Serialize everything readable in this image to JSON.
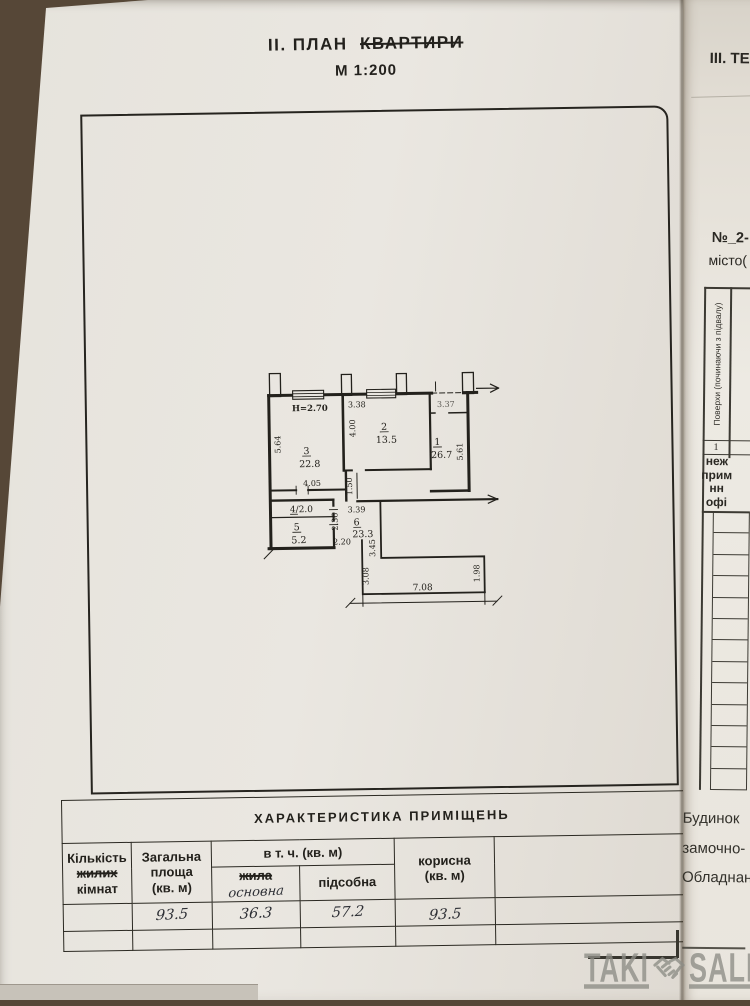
{
  "page1": {
    "title_prefix": "ІІ. ПЛАН",
    "title_struck": "КВАРТИРИ",
    "scale": "М 1:200",
    "floor_label": "І поверх",
    "plan": {
      "rooms": {
        "r1": {
          "num": "1",
          "area": "26.7"
        },
        "r2": {
          "num": "2",
          "area": "13.5"
        },
        "r3": {
          "num": "3",
          "area": "22.8"
        },
        "r4": {
          "label": "4/2.0"
        },
        "r5": {
          "num": "5",
          "area": "5.2"
        },
        "r6": {
          "num": "6",
          "area": "23.3"
        }
      },
      "dims": {
        "ceiling_height": "H=2.70",
        "r2_top": "3.38",
        "r1_top": "3.37",
        "r3_left": "5.64",
        "r2_left": "4.00",
        "r1_right": "5.61",
        "r3_bottom": "4.05",
        "corridor_width": "1.50",
        "r5_left": "2.36",
        "hall_top": "3.39",
        "r5_bottom": "2.20",
        "terrace_left": "3.08",
        "terrace_mid": "3.45",
        "terrace_bottom": "7.08",
        "terrace_right": "1.98"
      }
    },
    "table": {
      "title": "ХАРАКТЕРИСТИКА  ПРИМІЩЕНЬ",
      "col_rooms_l1": "Кількість",
      "col_rooms_struck": "жилих",
      "col_rooms_l2": "кімнат",
      "col_total_l1": "Загальна",
      "col_total_l2": "площа",
      "col_total_l3": "(кв. м)",
      "group_header": "в т. ч. (кв. м)",
      "sub_living_struck": "жила",
      "sub_living_hand": "основна",
      "sub_utility": "підсобна",
      "col_useful_l1": "корисна",
      "col_useful_l2": "(кв. м)",
      "values": {
        "total": "93.5",
        "living": "36.3",
        "utility": "57.2",
        "useful": "93.5"
      }
    }
  },
  "page2": {
    "section_header": "ІІІ. ТЕ",
    "doc_number": "№_2-",
    "city_line": "місто(",
    "floors_header": "Поверхи (починаючи з підвалу)",
    "row_value": "1",
    "bold_lines": [
      "неж",
      "прим",
      "нн",
      "офі"
    ],
    "bottom_lines": [
      "Будинок",
      "замочно-",
      "Обладнан"
    ]
  },
  "watermark": {
    "left": "TAKI",
    "right": "SALE"
  }
}
